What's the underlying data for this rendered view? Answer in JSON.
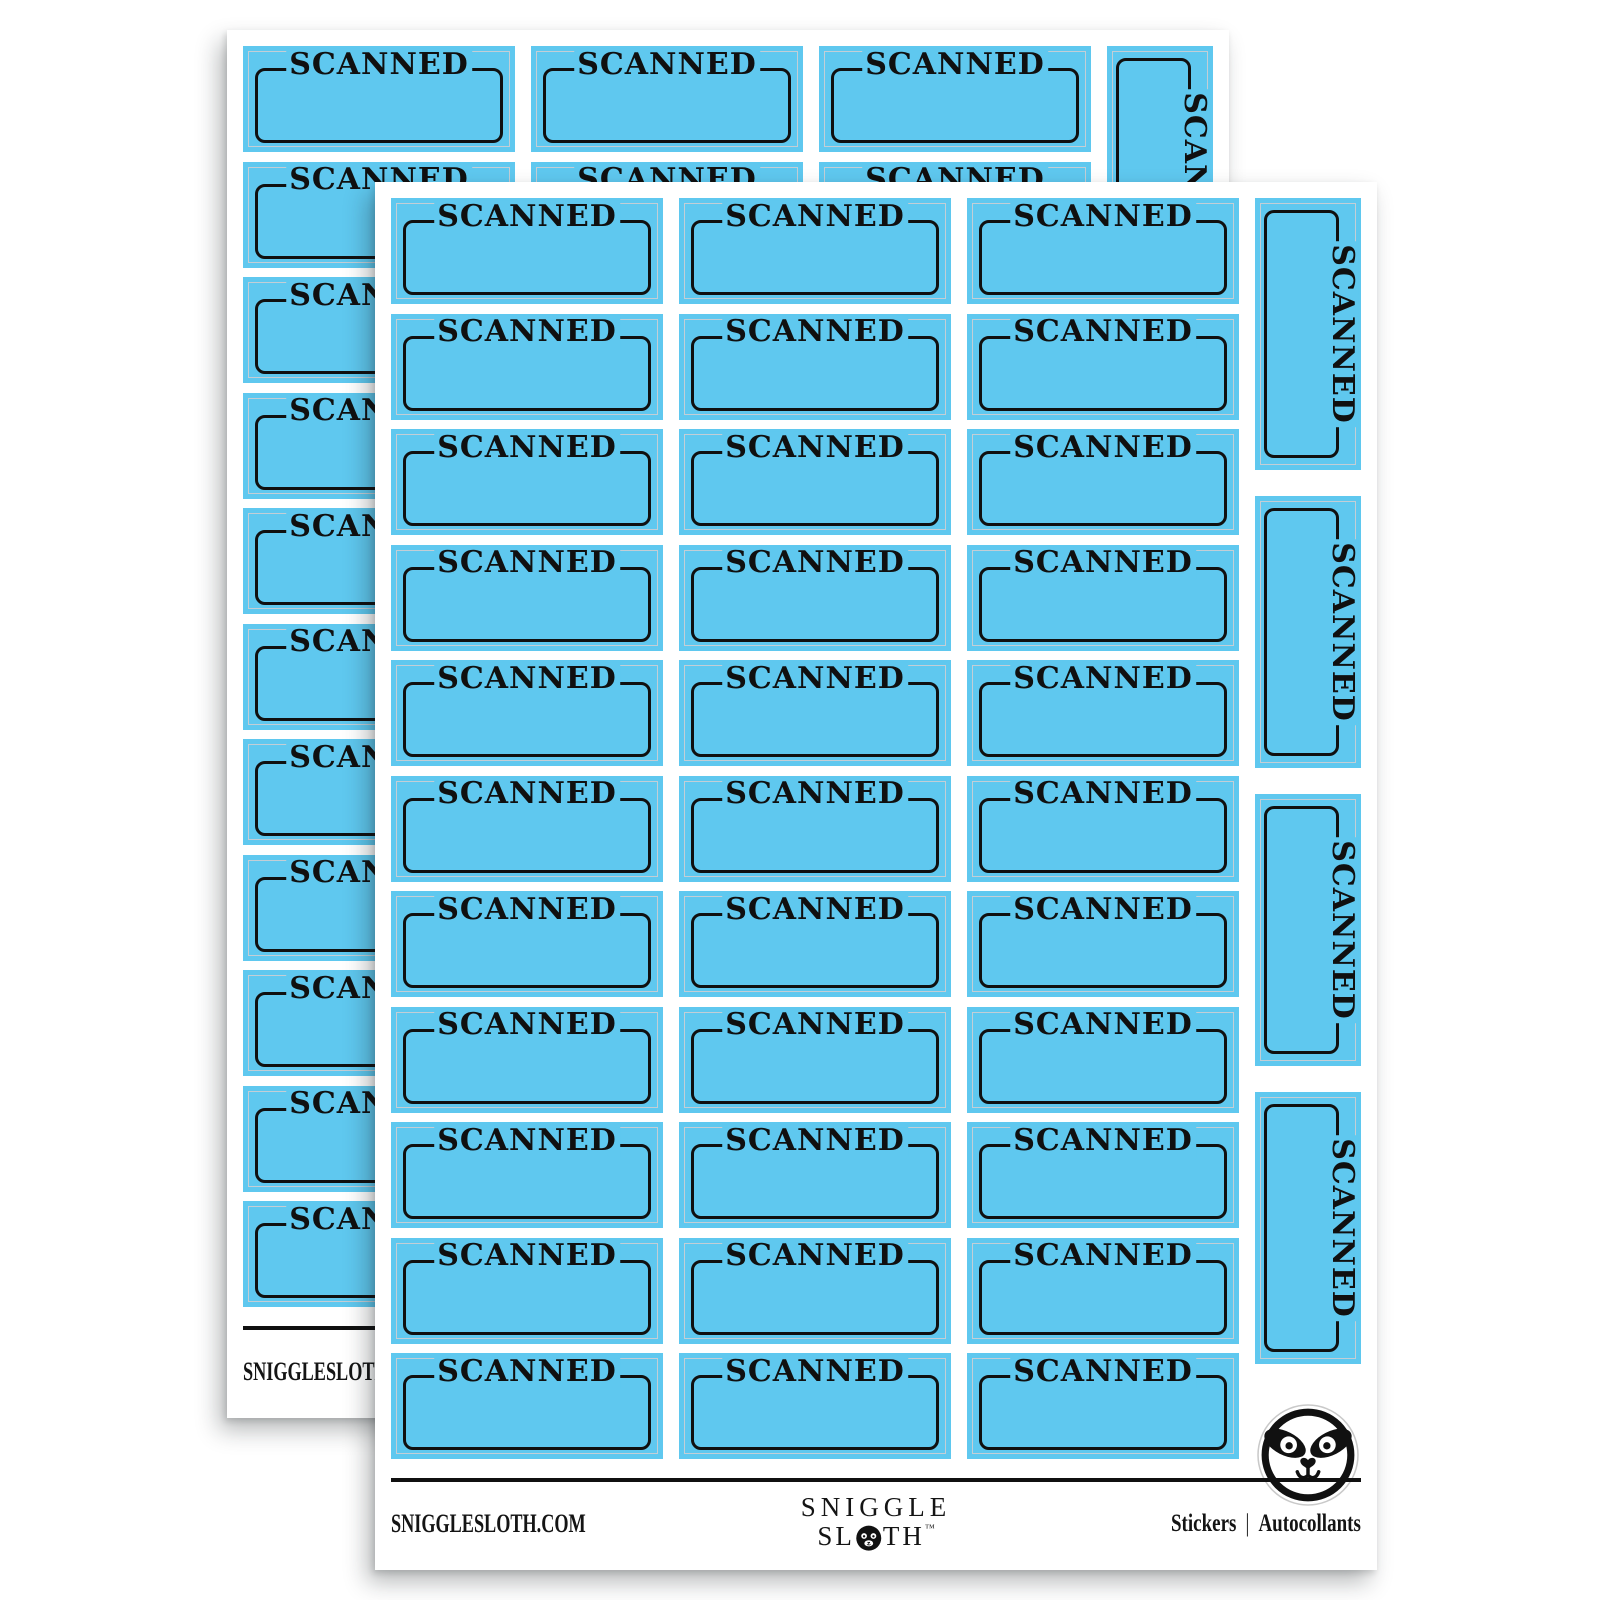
{
  "product": {
    "sticker_label": "SCANNED",
    "colors": {
      "sticker_blue": "#5fc8ef",
      "outline_black": "#101010",
      "cutline_gray": "#c3ced6",
      "sheet_white": "#ffffff"
    },
    "back_sheet": {
      "grid_rows": 11,
      "grid_cols": 3,
      "vertical_stickers": 4
    },
    "front_sheet": {
      "grid_rows": 11,
      "grid_cols": 3,
      "vertical_stickers": 4
    },
    "footer": {
      "website": "SNIGGLESLOTH.COM",
      "brand_top": "SNIGGLE",
      "brand_bottom_left": "SL",
      "brand_bottom_right": "TH",
      "trademark": "™",
      "type_en": "Stickers",
      "divider": "|",
      "type_fr": "Autocollants"
    }
  }
}
